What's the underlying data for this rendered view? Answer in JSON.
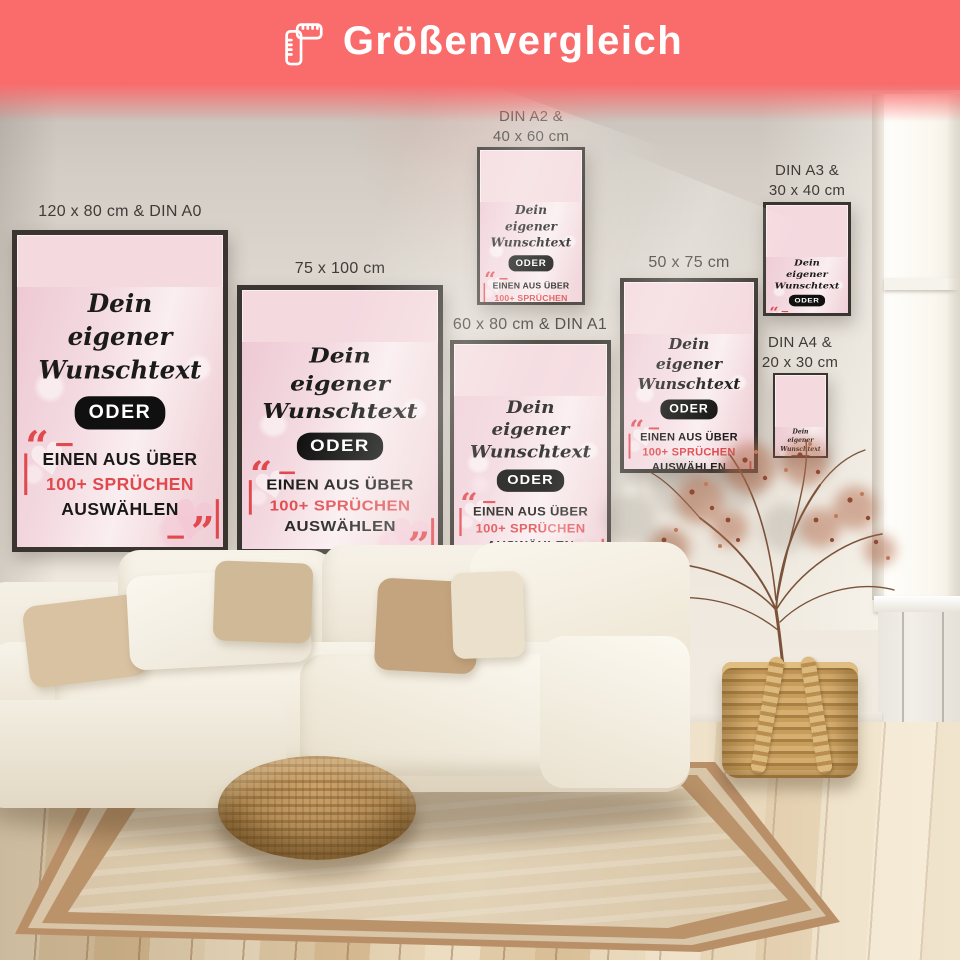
{
  "header": {
    "title": "Größenvergleich",
    "icon": "folding-ruler-icon",
    "background_color": "#fa6b6b",
    "text_color": "#ffffff"
  },
  "poster_design": {
    "script_lines": [
      "Dein",
      "eigener",
      "Wunschtext"
    ],
    "oder_label": "ODER",
    "quote_open": "“",
    "quote_close": "”",
    "slogan_line1": "EINEN AUS ÜBER",
    "slogan_line2": "100+ SPRÜCHEN",
    "slogan_line3": "AUSWÄHLEN",
    "accent_color": "#e0494e",
    "text_color": "#191919",
    "background_color": "#f4d9df",
    "frame_color": "#3a3531"
  },
  "posters": [
    {
      "id": "poster-120x80-din-a0",
      "label_line1": "120 x 80 cm & DIN A0",
      "label_line2": ""
    },
    {
      "id": "poster-75x100",
      "label_line1": "75 x 100 cm",
      "label_line2": ""
    },
    {
      "id": "poster-din-a2-40x60",
      "label_line1": "DIN A2 &",
      "label_line2": "40 x 60 cm"
    },
    {
      "id": "poster-60x80-din-a1",
      "label_line1": "60 x 80 cm & DIN A1",
      "label_line2": ""
    },
    {
      "id": "poster-50x75",
      "label_line1": "50 x 75 cm",
      "label_line2": ""
    },
    {
      "id": "poster-din-a3-30x40",
      "label_line1": "DIN A3 &",
      "label_line2": "30 x 40 cm"
    },
    {
      "id": "poster-din-a4-20x30",
      "label_line1": "DIN A4 &",
      "label_line2": "20 x 30 cm"
    }
  ]
}
